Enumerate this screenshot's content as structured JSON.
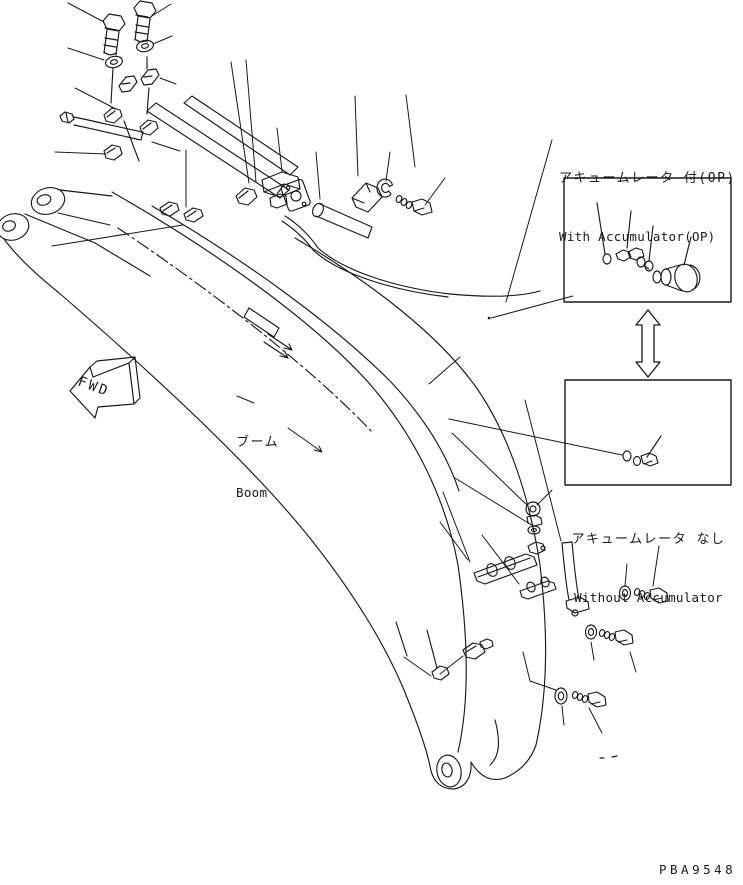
{
  "page": {
    "background_color": "#ffffff",
    "line_color": "#1a1a1a",
    "drawing_number": "PBA9548"
  },
  "labels": {
    "fwd_marker": "FWD",
    "boom_ja": "ブーム",
    "boom_en": "Boom",
    "with_accumulator_ja": "アキュームレータ 付(OP)",
    "with_accumulator_en": "With Accumulator(OP)",
    "without_accumulator_ja": "アキュームレータ なし",
    "without_accumulator_en": "Without Accumulator"
  },
  "diagram": {
    "type": "exploded-parts-line-drawing",
    "subject": "excavator boom hydraulic piping",
    "icons": [
      "fwd-direction-arrow",
      "swap-double-arrow"
    ],
    "detail_boxes": [
      "with-accumulator-option",
      "without-accumulator-standard"
    ],
    "parts_visible": [
      "boom",
      "hex-bolts",
      "washers",
      "pipe-clamps",
      "steel-tubes",
      "hoses",
      "elbow-fittings",
      "flanges",
      "o-rings",
      "valve",
      "accumulator",
      "plug"
    ]
  }
}
